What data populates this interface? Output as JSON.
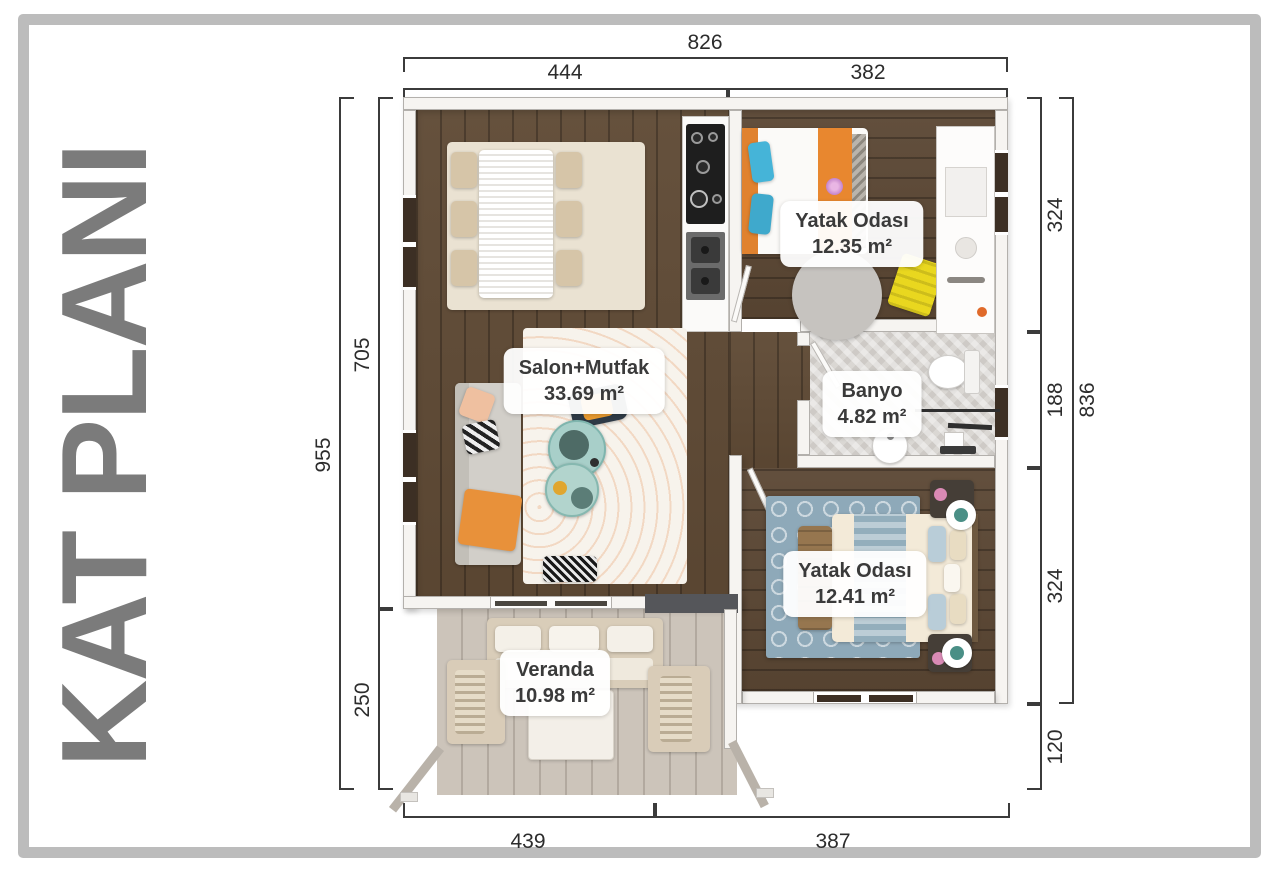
{
  "title": "KAT PLANI",
  "plan": {
    "rooms": [
      {
        "name": "Salon+Mutfak",
        "area": "33.69 m²"
      },
      {
        "name": "Yatak Odası",
        "area": "12.35 m²"
      },
      {
        "name": "Banyo",
        "area": "4.82 m²"
      },
      {
        "name": "Yatak Odası",
        "area": "12.41 m²"
      },
      {
        "name": "Veranda",
        "area": "10.98 m²"
      }
    ],
    "dimensions": {
      "top_total": "826",
      "top_left": "444",
      "top_right": "382",
      "left_total": "955",
      "left_upper": "705",
      "left_lower": "250",
      "right_top": "324",
      "right_middle": "188",
      "right_lower": "324",
      "right_bottom": "120",
      "right_total": "836",
      "bottom_left": "439",
      "bottom_right": "387"
    }
  },
  "colors": {
    "frame": "#bcbcbc",
    "title_text": "#7b7b7b",
    "dimension_line": "#3b3b3b",
    "wall": "#f6f4f1",
    "wood_floor": "#5f4a35",
    "veranda_deck": "#ccc4ba",
    "bathroom_tile": "#dad7d3",
    "label_text": "#3a3a3a",
    "accent_orange": "#e8872f",
    "accent_blue": "#45b4d8",
    "accent_yellow": "#e9d71f",
    "rug_blue": "#8ea9b9",
    "coffee_table_teal": "#a8cfc9"
  }
}
